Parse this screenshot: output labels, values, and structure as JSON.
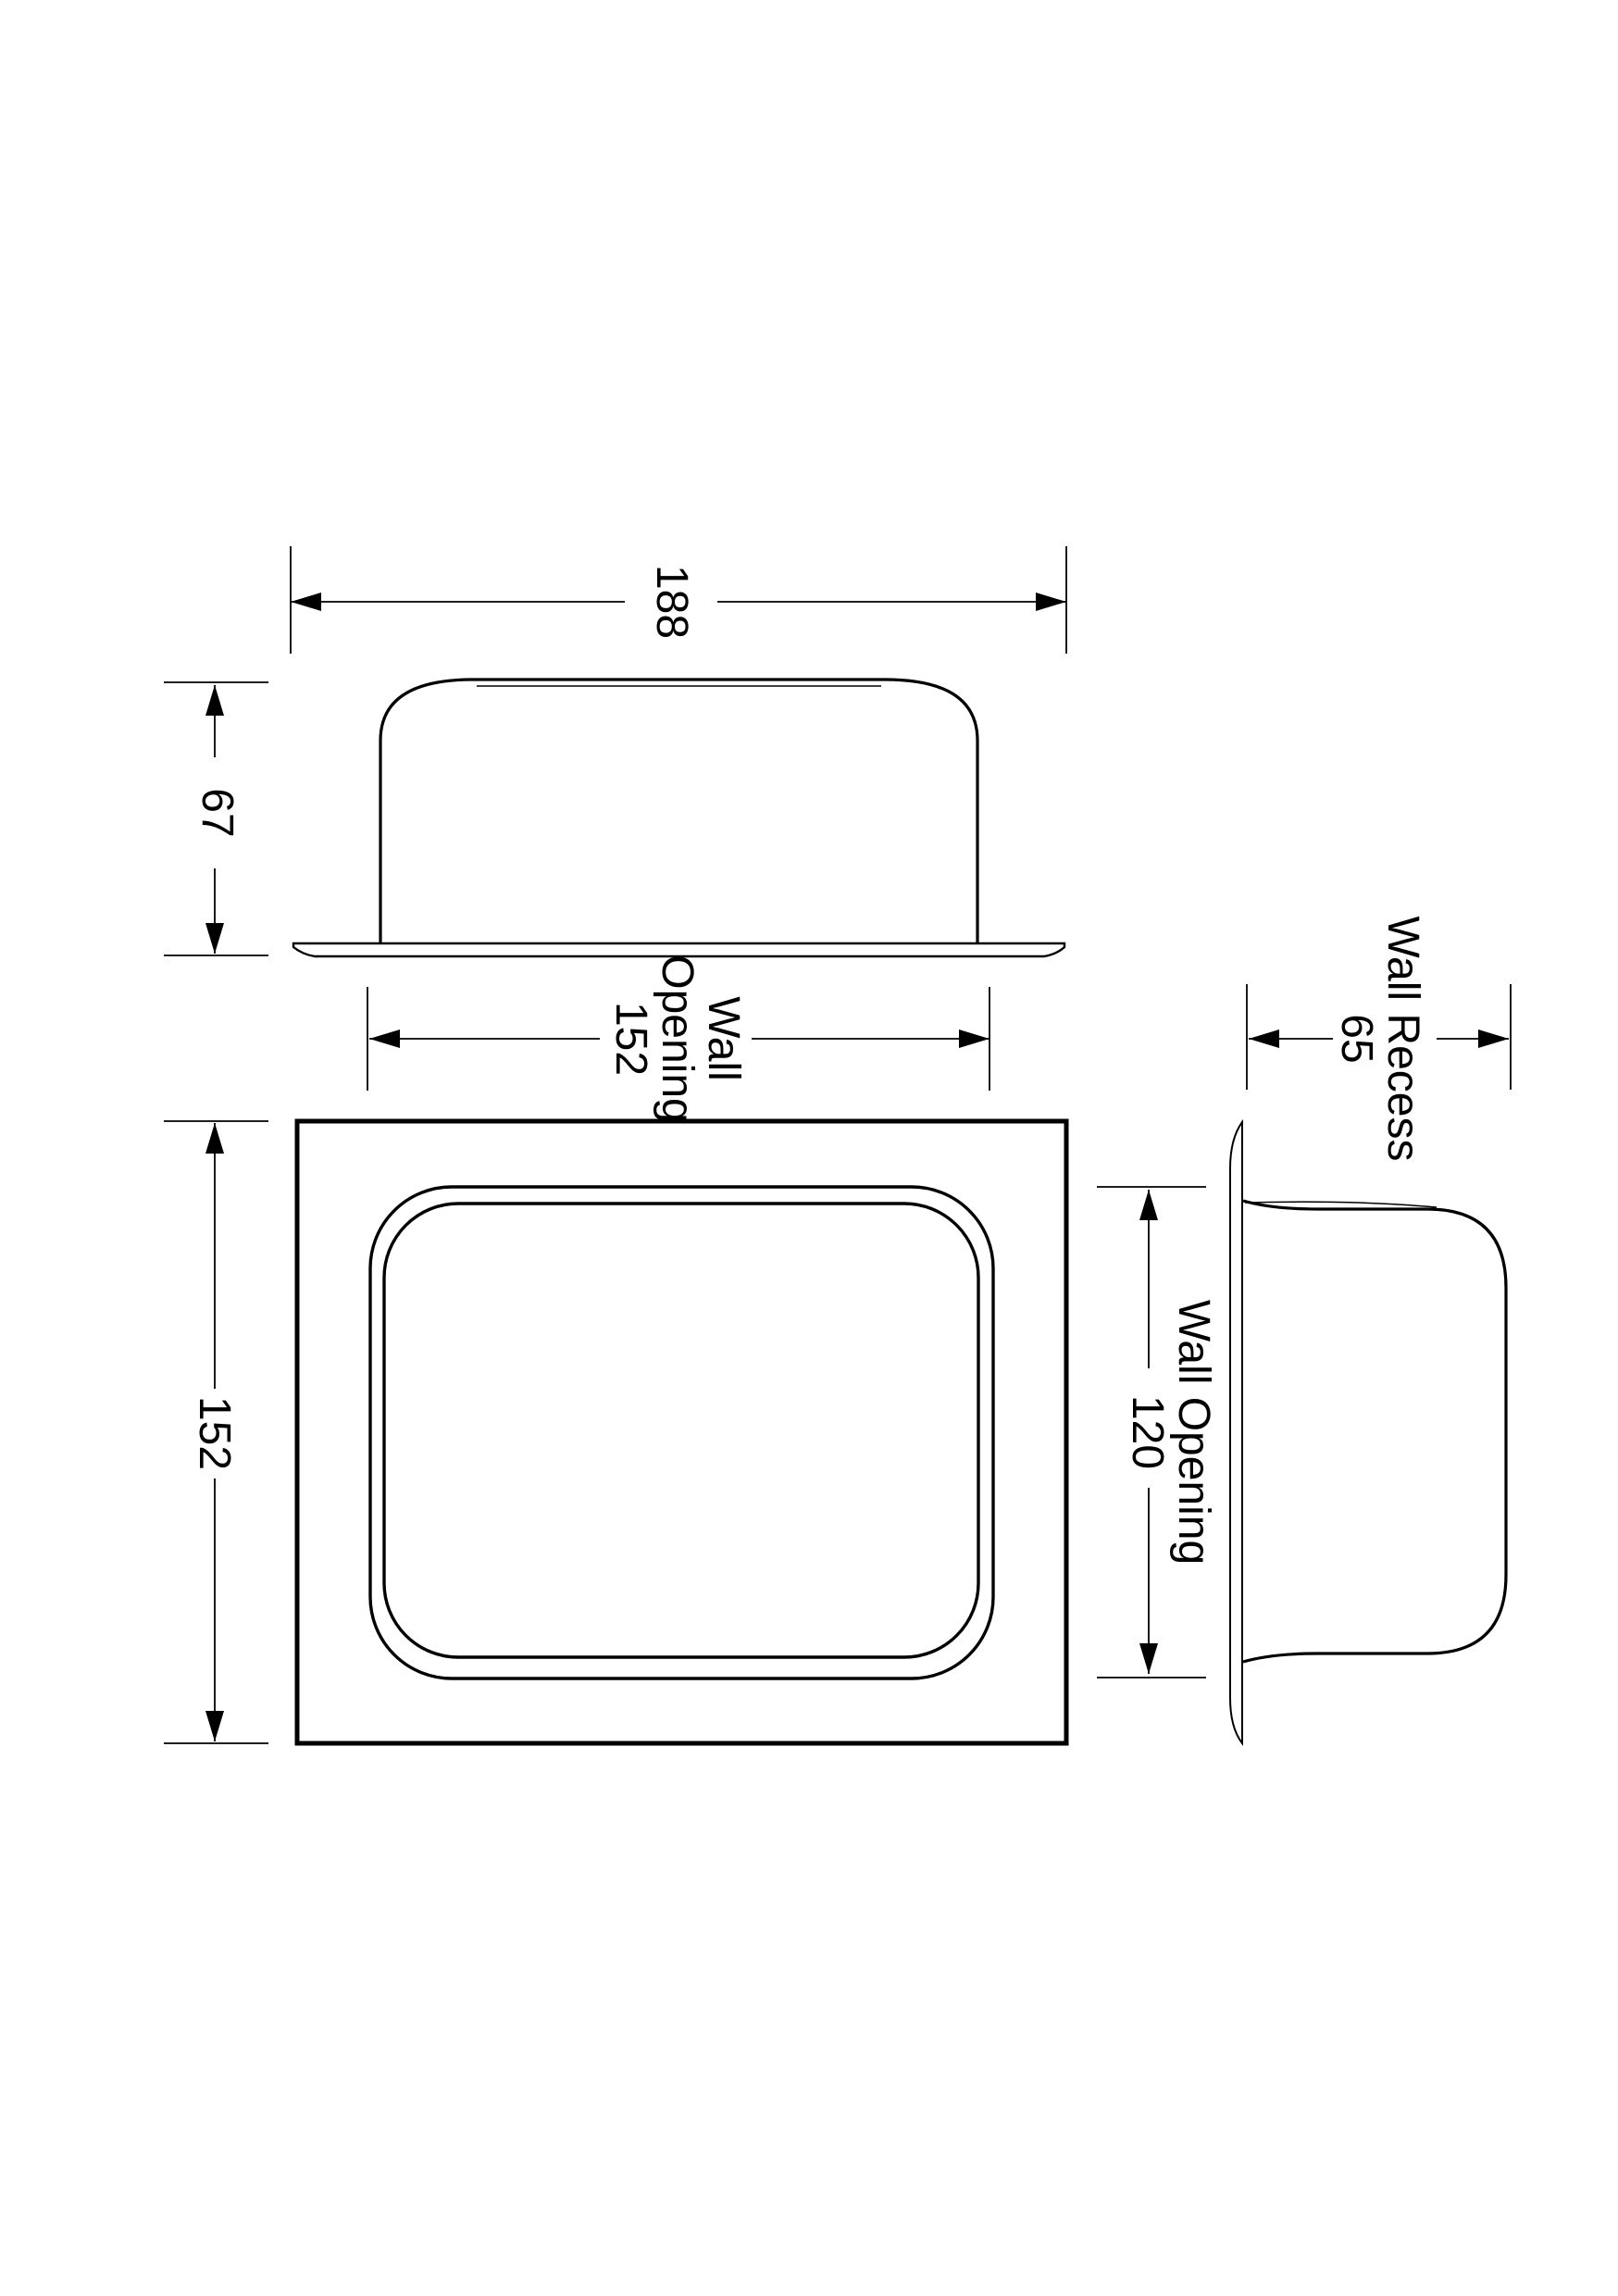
{
  "page": {
    "background": "#ffffff",
    "line_color": "#000000"
  },
  "dimensions": {
    "overall_width": {
      "value": "188"
    },
    "overall_depth": {
      "value": "67"
    },
    "wall_opening_horizontal": {
      "line1": "Wall",
      "line2": "Opening",
      "line3": "152"
    },
    "front_height": {
      "value": "152"
    },
    "wall_opening_vertical": {
      "line1": "Wall Opening",
      "line2": "120"
    },
    "wall_recess": {
      "line1": "Wall Recess",
      "line2": "65"
    }
  }
}
